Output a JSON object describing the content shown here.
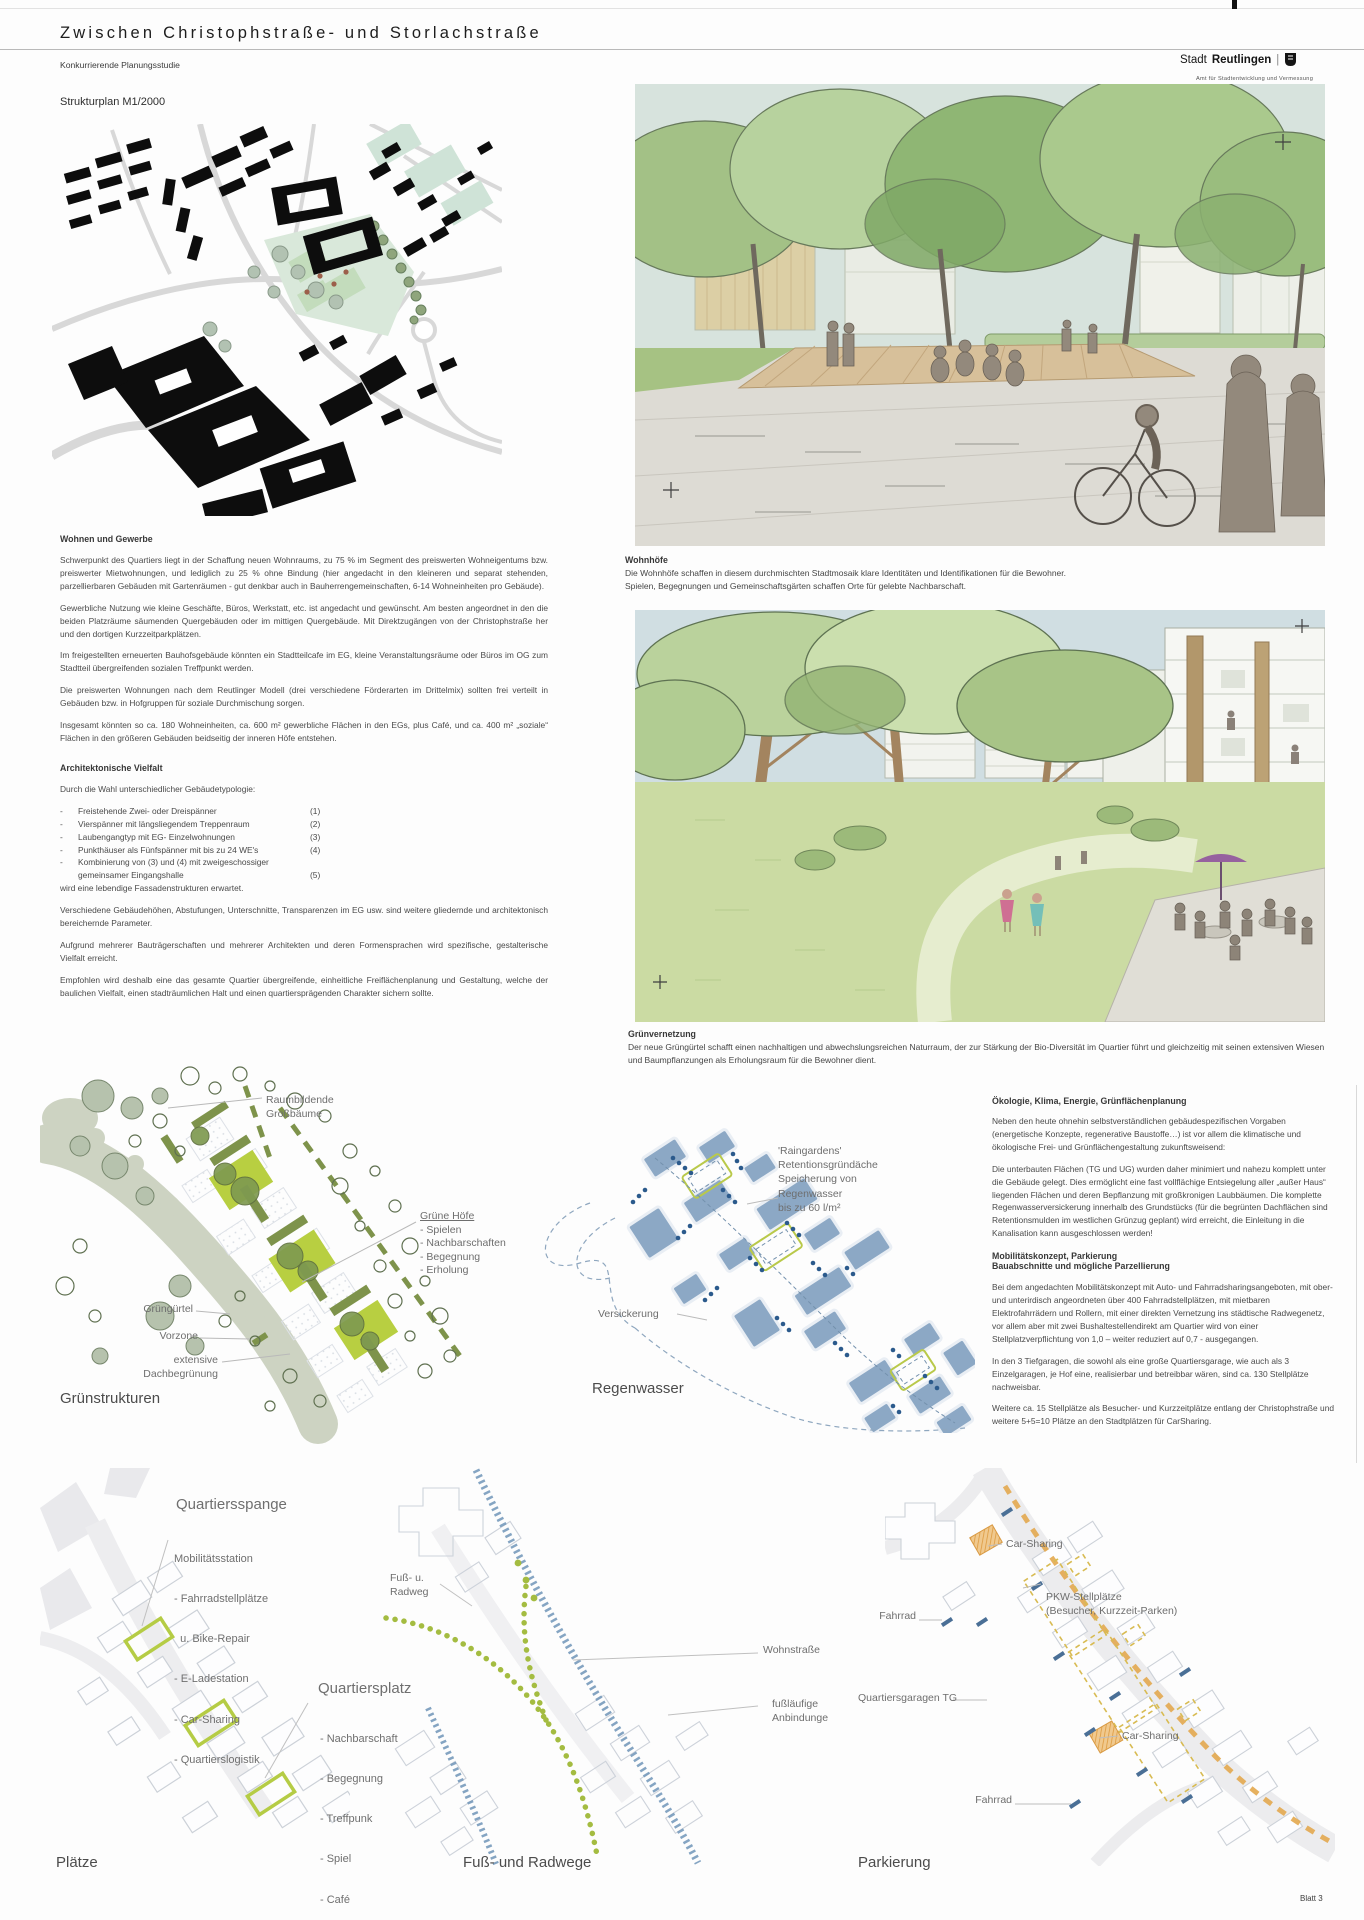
{
  "header": {
    "title": "Zwischen Christophstraße- und Storlachstraße",
    "subtitle": "Konkurrierende Planungsstudie",
    "logo": {
      "prefix": "Stadt",
      "name": "Reutlingen",
      "separator": "|",
      "department": "Amt für Stadtentwicklung und Vermessung"
    }
  },
  "strukturplan": {
    "title": "Strukturplan M1/2000"
  },
  "wohnen": {
    "heading": "Wohnen und Gewerbe",
    "paragraphs": [
      "Schwerpunkt des Quartiers liegt in der Schaffung neuen Wohnraums, zu 75 % im Segment des preiswerten Wohneigentums bzw. preiswerter Mietwohnungen, und lediglich zu 25 % ohne Bindung (hier angedacht in den kleineren und separat stehenden, parzellierbaren Gebäuden mit Gartenräumen - gut denkbar auch in Bauherrengemeinschaften, 6-14 Wohneinheiten pro Gebäude).",
      "Gewerbliche Nutzung wie kleine Geschäfte, Büros, Werkstatt, etc. ist angedacht und gewünscht. Am besten angeordnet in den die beiden Platzräume säumenden Quergebäuden oder im mittigen Quergebäude. Mit Direktzugängen von der Christophstraße her und den dortigen Kurzzeitparkplätzen.",
      "Im freigestellten erneuerten Bauhofsgebäude könnten ein Stadtteilcafe im EG, kleine Veranstaltungsräume oder Büros im OG zum Stadtteil übergreifenden sozialen Treffpunkt werden.",
      "Die preiswerten Wohnungen nach dem Reutlinger Modell (drei verschiedene Förderarten im Drittelmix) sollten frei verteilt in Gebäuden bzw. in Hofgruppen für soziale Durchmischung sorgen.",
      "Insgesamt könnten so ca. 180 Wohneinheiten, ca. 600 m² gewerbliche Flächen in den EGs, plus Café, und ca. 400 m² „soziale“ Flächen in den größeren Gebäuden beidseitig der inneren Höfe entstehen."
    ]
  },
  "vielfalt": {
    "heading": "Architektonische Vielfalt",
    "intro": "Durch die Wahl unterschiedlicher Gebäudetypologie:",
    "typologies": [
      {
        "dash": "-",
        "text": "Freistehende Zwei- oder Dreispänner",
        "num": "(1)"
      },
      {
        "dash": "-",
        "text": "Vierspänner mit längsliegendem Treppenraum",
        "num": "(2)"
      },
      {
        "dash": "-",
        "text": "Laubengangtyp mit EG- Einzelwohnungen",
        "num": "(3)"
      },
      {
        "dash": "-",
        "text": "Punkthäuser als Fünfspänner mit bis zu 24 WE's",
        "num": "(4)"
      },
      {
        "dash": "-",
        "text": "Kombinierung von (3) und (4) mit zweigeschossiger",
        "num": ""
      },
      {
        "dash": "",
        "text": "gemeinsamer Eingangshalle",
        "num": "(5)"
      }
    ],
    "outro": "wird eine lebendige Fassadenstrukturen erwartet.",
    "paragraphs": [
      "Verschiedene Gebäudehöhen, Abstufungen, Unterschnitte, Transparenzen im EG usw. sind weitere gliedernde und architektonisch bereichernde Parameter.",
      "Aufgrund mehrerer Bauträgerschaften und mehrerer Architekten und deren Formensprachen wird spezifische, gestalterische Vielfalt erreicht.",
      "Empfohlen wird deshalb eine das gesamte Quartier übergreifende, einheitliche Freiflächenplanung und Gestaltung, welche der baulichen Vielfalt, einen stadträumlichen Halt und einen quartiersprägenden Charakter sichern sollte."
    ]
  },
  "figures": {
    "wohnhoefe": {
      "title": "Wohnhöfe",
      "lines": [
        "Die Wohnhöfe schaffen in diesem durchmischten Stadtmosaik klare Identitäten und Identifikationen für die Bewohner.",
        "Spielen, Begegnungen und Gemeinschaftsgärten schaffen Orte für gelebte Nachbarschaft."
      ]
    },
    "gruenvernetzung": {
      "title": "Grünvernetzung",
      "lines": [
        "Der neue Grüngürtel schafft einen nachhaltigen und abwechslungsreichen Naturraum, der zur Stärkung der Bio-Diversität im Quartier führt und gleichzeitig mit seinen extensiven Wiesen",
        "und Baumpflanzungen als Erholungsraum für die Bewohner dient."
      ]
    }
  },
  "gruenstrukturen": {
    "title": "Grünstrukturen",
    "label_grossbaeume": [
      "Raumbildende",
      "Großbäume"
    ],
    "label_hoefe_heading": "Grüne Höfe",
    "label_hoefe_items": [
      "- Spielen",
      "- Nachbarschaften",
      "- Begegnung",
      "- Erholung"
    ],
    "label_guertel": "Grüngürtel",
    "label_vorzone": "Vorzone",
    "label_dach": [
      "extensive",
      "Dachbegrünung"
    ]
  },
  "regenwasser": {
    "title": "Regenwasser",
    "label_raingardens": [
      "'Raingardens'",
      "Retentionsgründäche",
      "Speicherung von",
      "Regenwasser",
      "bis zu 60 l/m²"
    ],
    "label_versickerung": "Versickerung"
  },
  "oekologie": {
    "heading": "Ökologie, Klima, Energie, Grünflächenplanung",
    "paragraphs": [
      "Neben den heute ohnehin selbstverständlichen gebäudespezifischen Vorgaben (energetische Konzepte, regenerative Baustoffe…) ist vor allem die klimatische und ökologische Frei- und Grünflächengestaltung zukunftsweisend:",
      "Die unterbauten Flächen (TG und UG) wurden daher minimiert und nahezu komplett unter die Gebäude gelegt. Dies ermöglicht eine fast vollflächige Entsiegelung aller „außer Haus“ liegenden Flächen und deren Bepflanzung mit großkronigen Laubbäumen. Die komplette Regenwasserversickerung innerhalb des Grundstücks (für die begrünten Dachflächen sind Retentionsmulden im westlichen Grünzug geplant) wird erreicht, die Einleitung in die Kanalisation kann ausgeschlossen werden!"
    ]
  },
  "mobilitaet": {
    "heading_lines": [
      "Mobilitätskonzept, Parkierung",
      "Bauabschnitte und mögliche Parzellierung"
    ],
    "paragraphs": [
      "Bei dem angedachten Mobilitätskonzept mit Auto- und Fahrradsharingsangeboten, mit ober- und unterirdisch angeordneten über 400 Fahrradstellplätzen, mit mietbaren Elektrofahrrädern und Rollern, mit einer direkten Vernetzung ins städtische Radwegenetz, vor allem aber mit zwei Bushaltestellendirekt am Quartier wird von einer Stellplatzverpflichtung von 1,0 – weiter reduziert auf 0,7 - ausgegangen.",
      "In den 3 Tiefgaragen, die sowohl als eine große Quartiersgarage, wie auch als 3 Einzelgaragen, je Hof eine, realisierbar und betreibbar wären, sind ca. 130 Stellplätze nachweisbar.",
      "Weitere ca. 15 Stellplätze als Besucher- und Kurzzeitplätze entlang der Christophstraße und weitere 5+5=10 Plätze an den Stadtplätzen für CarSharing."
    ]
  },
  "plaetze": {
    "title": "Plätze",
    "spange_heading": "Quartiersspange",
    "spange_sub": "Mobilitätsstation",
    "spange_items": [
      "- Fahrradstellplätze",
      "  u. Bike-Repair",
      "- E-Ladestation",
      "- Car-Sharing",
      "- Quartierslogistik"
    ],
    "platz_heading": "Quartiersplatz",
    "platz_items": [
      "- Nachbarschaft",
      "- Begegnung",
      "- Treffpunk",
      "- Spiel",
      "- Café",
      "- Gemeinschaftsraum"
    ]
  },
  "wege": {
    "title": "Fuß- und Radwege",
    "label_fussradweg": [
      "Fuß- u.",
      "Radweg"
    ],
    "label_wohnstrasse": "Wohnstraße",
    "label_anbindung": [
      "fußläufige",
      "Anbindunge"
    ]
  },
  "parkierung": {
    "title": "Parkierung",
    "label_carsharing_top": "Car-Sharing",
    "label_pkw": [
      "PKW-Stellplätze",
      "(Besucher, Kurzzeit-Parken)"
    ],
    "label_fahrrad_left": "Fahrrad",
    "label_tg": "Quartiersgaragen TG",
    "label_carsharing_right": "Car-Sharing",
    "label_fahrrad_bottom": "Fahrrad",
    "colors": {
      "orange": "#e3a94f",
      "bike_blue": "#4a6f96",
      "tg_yellow": "#d8bb52"
    }
  },
  "footer": {
    "sheet": "Blatt 3"
  }
}
